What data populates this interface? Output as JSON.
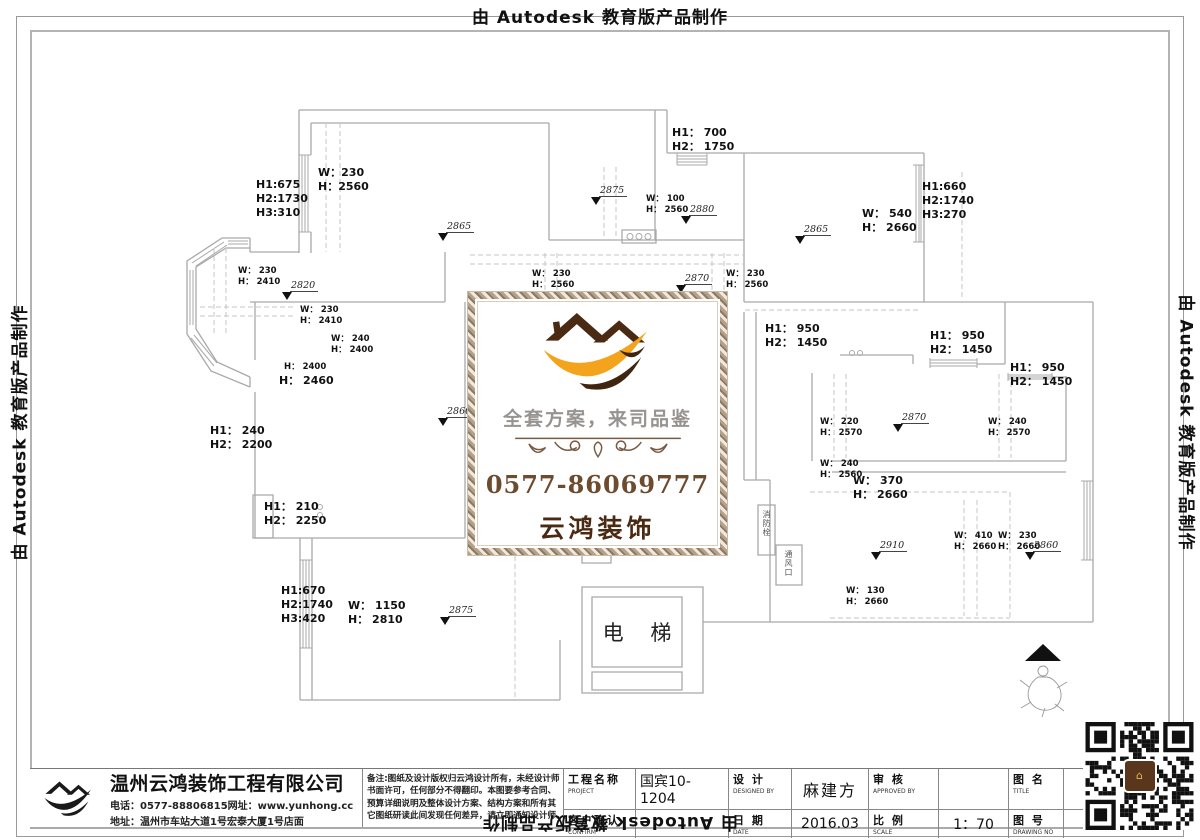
{
  "watermark": {
    "full": "由 Autodesk 教育版产品制作"
  },
  "plan": {
    "dim_labels": [
      {
        "x": 256,
        "y": 178,
        "size": "md",
        "lines": [
          "H1:675",
          "H2:1730",
          "H3:310"
        ]
      },
      {
        "x": 318,
        "y": 166,
        "size": "md",
        "lines": [
          "W：230",
          "H：2560"
        ]
      },
      {
        "x": 672,
        "y": 126,
        "size": "md",
        "lines": [
          "H1： 700",
          "H2： 1750"
        ]
      },
      {
        "x": 646,
        "y": 194,
        "size": "sm",
        "lines": [
          "W： 100",
          "H： 2560"
        ]
      },
      {
        "x": 862,
        "y": 207,
        "size": "md",
        "lines": [
          "W： 540",
          "H： 2660"
        ]
      },
      {
        "x": 922,
        "y": 180,
        "size": "md",
        "lines": [
          "H1:660",
          "H2:1740",
          "H3:270"
        ]
      },
      {
        "x": 238,
        "y": 266,
        "size": "sm",
        "lines": [
          "W： 230",
          "H： 2410"
        ]
      },
      {
        "x": 300,
        "y": 305,
        "size": "sm",
        "lines": [
          "W： 230",
          "H： 2410"
        ]
      },
      {
        "x": 532,
        "y": 269,
        "size": "sm",
        "lines": [
          "W： 230",
          "H： 2560"
        ]
      },
      {
        "x": 726,
        "y": 269,
        "size": "sm",
        "lines": [
          "W： 230",
          "H： 2560"
        ]
      },
      {
        "x": 331,
        "y": 334,
        "size": "sm",
        "lines": [
          "W： 240",
          "H： 2400"
        ]
      },
      {
        "x": 284,
        "y": 362,
        "size": "sm",
        "lines": [
          "H： 2400"
        ]
      },
      {
        "x": 279,
        "y": 374,
        "size": "md",
        "lines": [
          "H： 2460"
        ]
      },
      {
        "x": 765,
        "y": 322,
        "size": "md",
        "lines": [
          "H1： 950",
          "H2： 1450"
        ]
      },
      {
        "x": 930,
        "y": 329,
        "size": "md",
        "lines": [
          "H1： 950",
          "H2： 1450"
        ]
      },
      {
        "x": 1010,
        "y": 361,
        "size": "md",
        "lines": [
          "H1： 950",
          "H2： 1450"
        ]
      },
      {
        "x": 210,
        "y": 424,
        "size": "md",
        "lines": [
          "H1： 240",
          "H2： 2200"
        ]
      },
      {
        "x": 820,
        "y": 417,
        "size": "sm",
        "lines": [
          "W： 220",
          "H： 2570"
        ]
      },
      {
        "x": 988,
        "y": 417,
        "size": "sm",
        "lines": [
          "W： 240",
          "H： 2570"
        ]
      },
      {
        "x": 820,
        "y": 459,
        "size": "sm",
        "lines": [
          "W： 240",
          "H： 2560"
        ]
      },
      {
        "x": 853,
        "y": 474,
        "size": "md",
        "lines": [
          "W： 370",
          "H： 2660"
        ]
      },
      {
        "x": 581,
        "y": 494,
        "size": "md",
        "lines": [
          "W： 370",
          "H： 2660"
        ]
      },
      {
        "x": 264,
        "y": 500,
        "size": "md",
        "lines": [
          "H1： 210",
          "H2： 2250"
        ]
      },
      {
        "x": 954,
        "y": 531,
        "size": "sm",
        "lines": [
          "W： 410",
          "H： 2660"
        ]
      },
      {
        "x": 998,
        "y": 531,
        "size": "sm",
        "lines": [
          "W： 230",
          "H： 2660"
        ]
      },
      {
        "x": 846,
        "y": 586,
        "size": "sm",
        "lines": [
          "W： 130",
          "H： 2660"
        ]
      },
      {
        "x": 281,
        "y": 584,
        "size": "md",
        "lines": [
          "H1:670",
          "H2:1740",
          "H3:420"
        ]
      },
      {
        "x": 348,
        "y": 599,
        "size": "md",
        "lines": [
          "W： 1150",
          "H： 2810"
        ]
      }
    ],
    "level_markers": [
      {
        "x": 438,
        "y": 214,
        "value": "2865"
      },
      {
        "x": 591,
        "y": 178,
        "value": "2875"
      },
      {
        "x": 681,
        "y": 197,
        "value": "2880"
      },
      {
        "x": 795,
        "y": 217,
        "value": "2865"
      },
      {
        "x": 282,
        "y": 273,
        "value": "2820"
      },
      {
        "x": 676,
        "y": 266,
        "value": "2870"
      },
      {
        "x": 438,
        "y": 399,
        "value": "2860"
      },
      {
        "x": 893,
        "y": 405,
        "value": "2870"
      },
      {
        "x": 871,
        "y": 533,
        "value": "2910"
      },
      {
        "x": 1025,
        "y": 533,
        "value": "2860"
      },
      {
        "x": 440,
        "y": 598,
        "value": "2875"
      }
    ],
    "elevator": "电 梯",
    "fire_hydrant": "消防栓",
    "vent": "通风口"
  },
  "center_banner": {
    "slogan": "全套方案，来司品鉴",
    "phone": "0577-86069777",
    "brand": "云鸿装饰"
  },
  "title_block": {
    "company": "温州云鸿装饰工程有限公司",
    "contact_line": "电话：0577-88806815网址：www.yunhong.cc",
    "address_line": "地址：温州市车站大道1号宏泰大厦1号店面",
    "notes": [
      "备注:图纸及设计版权归云鸿设计所有，未经设计师",
      "书面许可，任何部分不得翻印。本图要参考合同、",
      "预算详细说明及整体设计方案、结构方案和所有其",
      "它图纸研读此间发现任何差异，请立即通知设计师。"
    ],
    "fields": {
      "project_label": "工程名称",
      "project_label_en": "PROJECT",
      "project_value": "国宾10-1204",
      "designed_label": "设 计",
      "designed_label_en": "DESIGNED BY",
      "designed_value": "麻建方",
      "approved_label": "审 核",
      "approved_label_en": "APPROVED BY",
      "approved_value": "",
      "title_label": "图 名",
      "title_label_en": "TITLE",
      "title_value": "",
      "confirm_label": "客户确认",
      "confirm_label_en": "CONFIRM",
      "confirm_value": "",
      "date_label": "日 期",
      "date_label_en": "DATE",
      "date_value": "2016.03",
      "scale_label": "比 例",
      "scale_label_en": "SCALE",
      "scale_value": "1：70",
      "drawing_no_label": "图 号",
      "drawing_no_label_en": "DRAWING NO",
      "drawing_no_value": ""
    }
  }
}
